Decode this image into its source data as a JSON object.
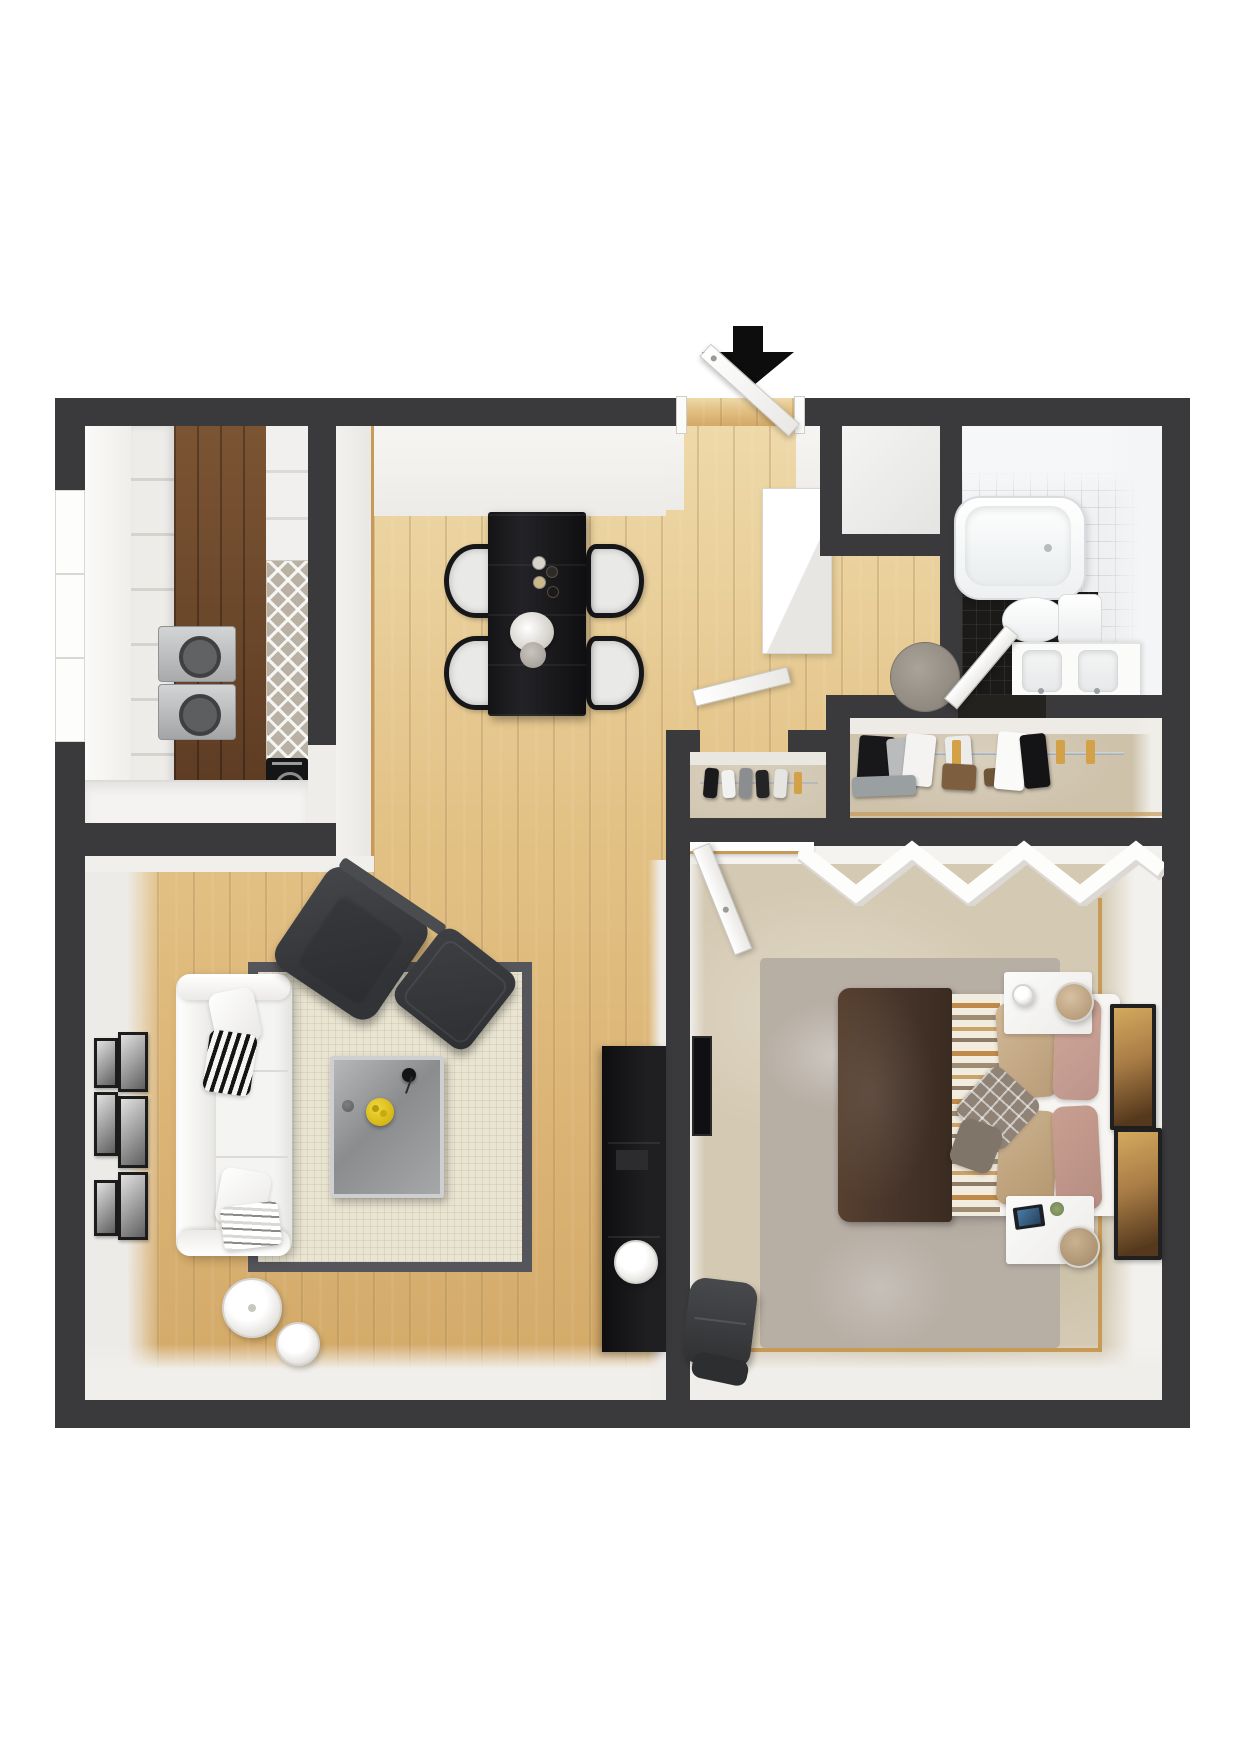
{
  "meta": {
    "type": "3d-floor-plan-render",
    "description": "Top-down 3D rendering of a one-bedroom, one-bath apartment floor plan with furnished rooms and an entry arrow at the top door",
    "canvas": {
      "width": 1240,
      "height": 1754
    },
    "text_visible": "none"
  },
  "colors": {
    "wall": "#3a3a3c",
    "wallDeep": "#343436",
    "woodLight": "#e0bd7f",
    "woodDark": "#64432a",
    "carpet": "#d4c9b2",
    "closetFloor": "#cec2ab",
    "rugLiving": "#eae5d3",
    "rugBorder": "#55565b",
    "rugBedroom": "#b7aea4",
    "tileLight": "#f0f2f3",
    "tileDark": "#1b1a19",
    "sofaWhite": "#f4f4f3",
    "chairCharcoal": "#393b3e",
    "diningTable": "#1a1a1c",
    "coffeeTable": "#97999b",
    "duvetBrown": "#4a372b",
    "pillowTan": "#c7ae8d",
    "pillowPink": "#c79e92",
    "trimTan": "#c79a58",
    "lemonYellow": "#e2c31e",
    "hangerWood": "#d2a148",
    "consoleBlack": "#121214",
    "doorWhite": "#f7f7f5",
    "arrowBlack": "#0d0d0d"
  },
  "entry": {
    "label": "Main entrance",
    "arrow": "black arrow pointing down at entry door",
    "door_state": "open"
  },
  "rooms": {
    "kitchen": {
      "name": "Kitchen",
      "floor": "dark hardwood",
      "furniture": [
        "white cabinet run",
        "cooktop with two burners",
        "tall lattice pantry unit",
        "black oven",
        "lower counter",
        "side window"
      ]
    },
    "dining": {
      "name": "Dining Area",
      "floor": "light hardwood",
      "furniture": [
        "black dining table",
        "four black chairs with white cushions",
        "candles",
        "flower vase"
      ]
    },
    "living": {
      "name": "Living Room",
      "floor": "light hardwood",
      "furniture": [
        "white three-seat sofa",
        "charcoal armchair",
        "charcoal ottoman",
        "gray coffee table",
        "bordered area rug",
        "gallery wall of six photos",
        "floor lamp",
        "black media console"
      ]
    },
    "hallway": {
      "name": "Entry Hall",
      "floor": "light hardwood",
      "furniture": [
        "white storage cabinet",
        "round door mat"
      ]
    },
    "entry_closet": {
      "name": "Entry Closet",
      "floor": "light",
      "furniture": []
    },
    "bathroom": {
      "name": "Bathroom",
      "floor": "white tile with black tile section",
      "furniture": [
        "bathtub",
        "toilet",
        "double-sink vanity",
        "round bath mat",
        "door"
      ]
    },
    "closet_small": {
      "name": "Closet",
      "floor": "carpet",
      "furniture": [
        "clothes rail with garments",
        "open door"
      ]
    },
    "closet_wide": {
      "name": "Wardrobe Closet",
      "floor": "carpet",
      "furniture": [
        "long chrome clothes rail",
        "hanging garments",
        "wood hangers",
        "shoe mats"
      ]
    },
    "bedroom": {
      "name": "Bedroom",
      "floor": "beige carpet",
      "furniture": [
        "double bed with brown duvet and striped blanket",
        "two white nightstands",
        "two cylinder lamps",
        "gray shag rug",
        "zigzag wall shelf",
        "two amber art frames",
        "dark bench pouf",
        "wall TV panel",
        "open door"
      ]
    }
  },
  "furniture": {
    "entry_arrow": "Entrance direction arrow",
    "entry_door": "Open entry door",
    "window": "Kitchen side window",
    "cabinets": "White kitchen cabinet run",
    "stove": "Cooktop with two burners",
    "oven": "Black oven/appliance",
    "pantry": "Tall lattice pantry unit",
    "counter": "Kitchen counter",
    "dining_table": "Black dining table",
    "dining_chair": "Black chair with white cushion",
    "vase": "Flower vase",
    "candles": "Table candles",
    "sofa": "White three-seat sofa",
    "armchair": "Charcoal armchair",
    "ottoman": "Charcoal ottoman",
    "coffee_table": "Gray coffee table with lemons and vase",
    "area_rug": "Cream rug with dark border",
    "gallery": "Gallery wall photo frame",
    "floor_lamp": "White floor lamp",
    "console": "Black media console",
    "tv": "Wall TV panel",
    "hall_cabinet": "White hall cabinet",
    "hall_mat": "Round gray mat",
    "bathtub": "Bathtub",
    "toilet": "Toilet",
    "vanity": "Double-sink vanity",
    "bath_mat": "Round bath mat",
    "bathroom_door": "Open bathroom door",
    "closet_door": "Open closet door",
    "closet_rail": "Chrome clothes rail",
    "garment": "Hanging garment",
    "hanger": "Wood hangers",
    "bed": "Double bed",
    "duvet": "Brown duvet",
    "striped_blanket": "Striped blanket",
    "pillow": "Bed pillow",
    "nightstand": "White nightstand",
    "lamp": "Cylinder table lamp",
    "tablet": "Tablet on nightstand",
    "art": "Framed amber artwork",
    "shag_rug": "Gray shag rug",
    "zigzag_shelf": "White zigzag wall shelf",
    "pouf": "Dark bench pouf",
    "bedroom_door": "Open bedroom door"
  }
}
